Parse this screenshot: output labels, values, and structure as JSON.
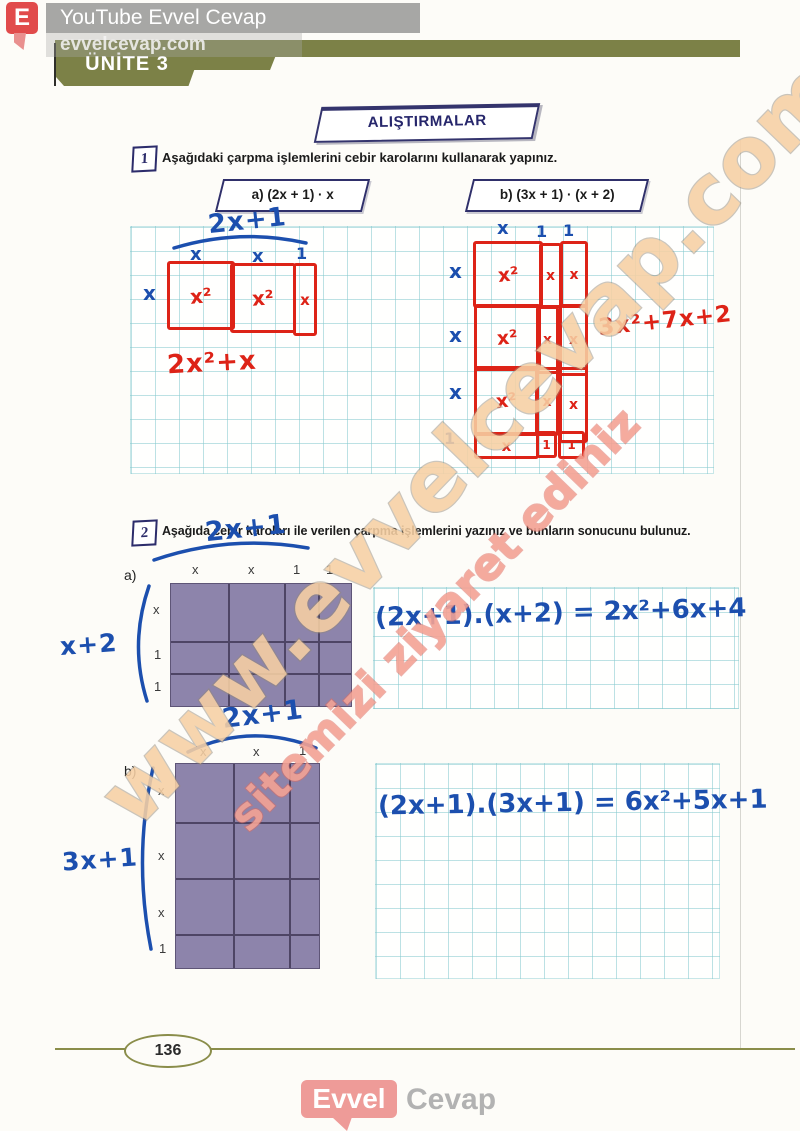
{
  "colors": {
    "olive": "#7c8147",
    "navy": "#2e2e6b",
    "red_ink": "#dd2317",
    "blue_ink": "#1c4fae",
    "tile_purple": "#8d84ab",
    "logo_pink": "#ee9b98",
    "watermark_tan": "#f7d0a4",
    "watermark_salmon": "#f4a294"
  },
  "overlay": {
    "badge": "E",
    "channel": "YouTube Evvel Cevap",
    "site": "evvelcevap.com"
  },
  "unit": {
    "label": "ÜNİTE 3"
  },
  "section": {
    "title": "ALIŞTIRMALAR"
  },
  "q1": {
    "number": "1",
    "prompt": "Aşağıdaki çarpma işlemlerini cebir karolarını kullanarak yapınız.",
    "a": {
      "box_label": "a) (2x + 1) · x",
      "hand_factor_top": "2x+1",
      "col_labels": [
        "x",
        "x",
        "1"
      ],
      "row_label": "x",
      "tile_labels": [
        "x²",
        "x²",
        "x"
      ],
      "hand_result": "2x²+x"
    },
    "b": {
      "box_label": "b) (3x + 1) · (x + 2)",
      "col_labels": [
        "x",
        "1",
        "1"
      ],
      "row_labels": [
        "x",
        "x",
        "x",
        "1"
      ],
      "tile_labels": [
        "x²",
        "x",
        "x",
        "x²",
        "x",
        "x",
        "x²",
        "x",
        "x",
        "x",
        "1",
        "1"
      ],
      "hand_result": "3x²+7x+2"
    }
  },
  "q2": {
    "number": "2",
    "prompt": "Aşağıda cebir karoları ile verilen çarpma işlemlerini yazınız ve bunların sonucunu bulunuz.",
    "a": {
      "item_label": "a)",
      "hand_factor_top": "2x+1",
      "hand_factor_left": "x+2",
      "col_labels": [
        "x",
        "x",
        "1",
        "1"
      ],
      "row_labels": [
        "x",
        "1",
        "1"
      ],
      "hand_answer": "(2x+1).(x+2) = 2x²+6x+4"
    },
    "b": {
      "item_label": "b)",
      "hand_factor_top": "2x+1",
      "hand_factor_left": "3x+1",
      "col_labels": [
        "x",
        "x",
        "1"
      ],
      "row_labels": [
        "x",
        "x",
        "x",
        "1"
      ],
      "hand_answer": "(2x+1).(3x+1) = 6x²+5x+1"
    }
  },
  "watermark": {
    "line1": "www.evvelcevap.com",
    "line2": "sitemizi ziyaret ediniz"
  },
  "footer": {
    "page_number": "136",
    "logo_primary": "Evvel",
    "logo_secondary": "Cevap"
  }
}
